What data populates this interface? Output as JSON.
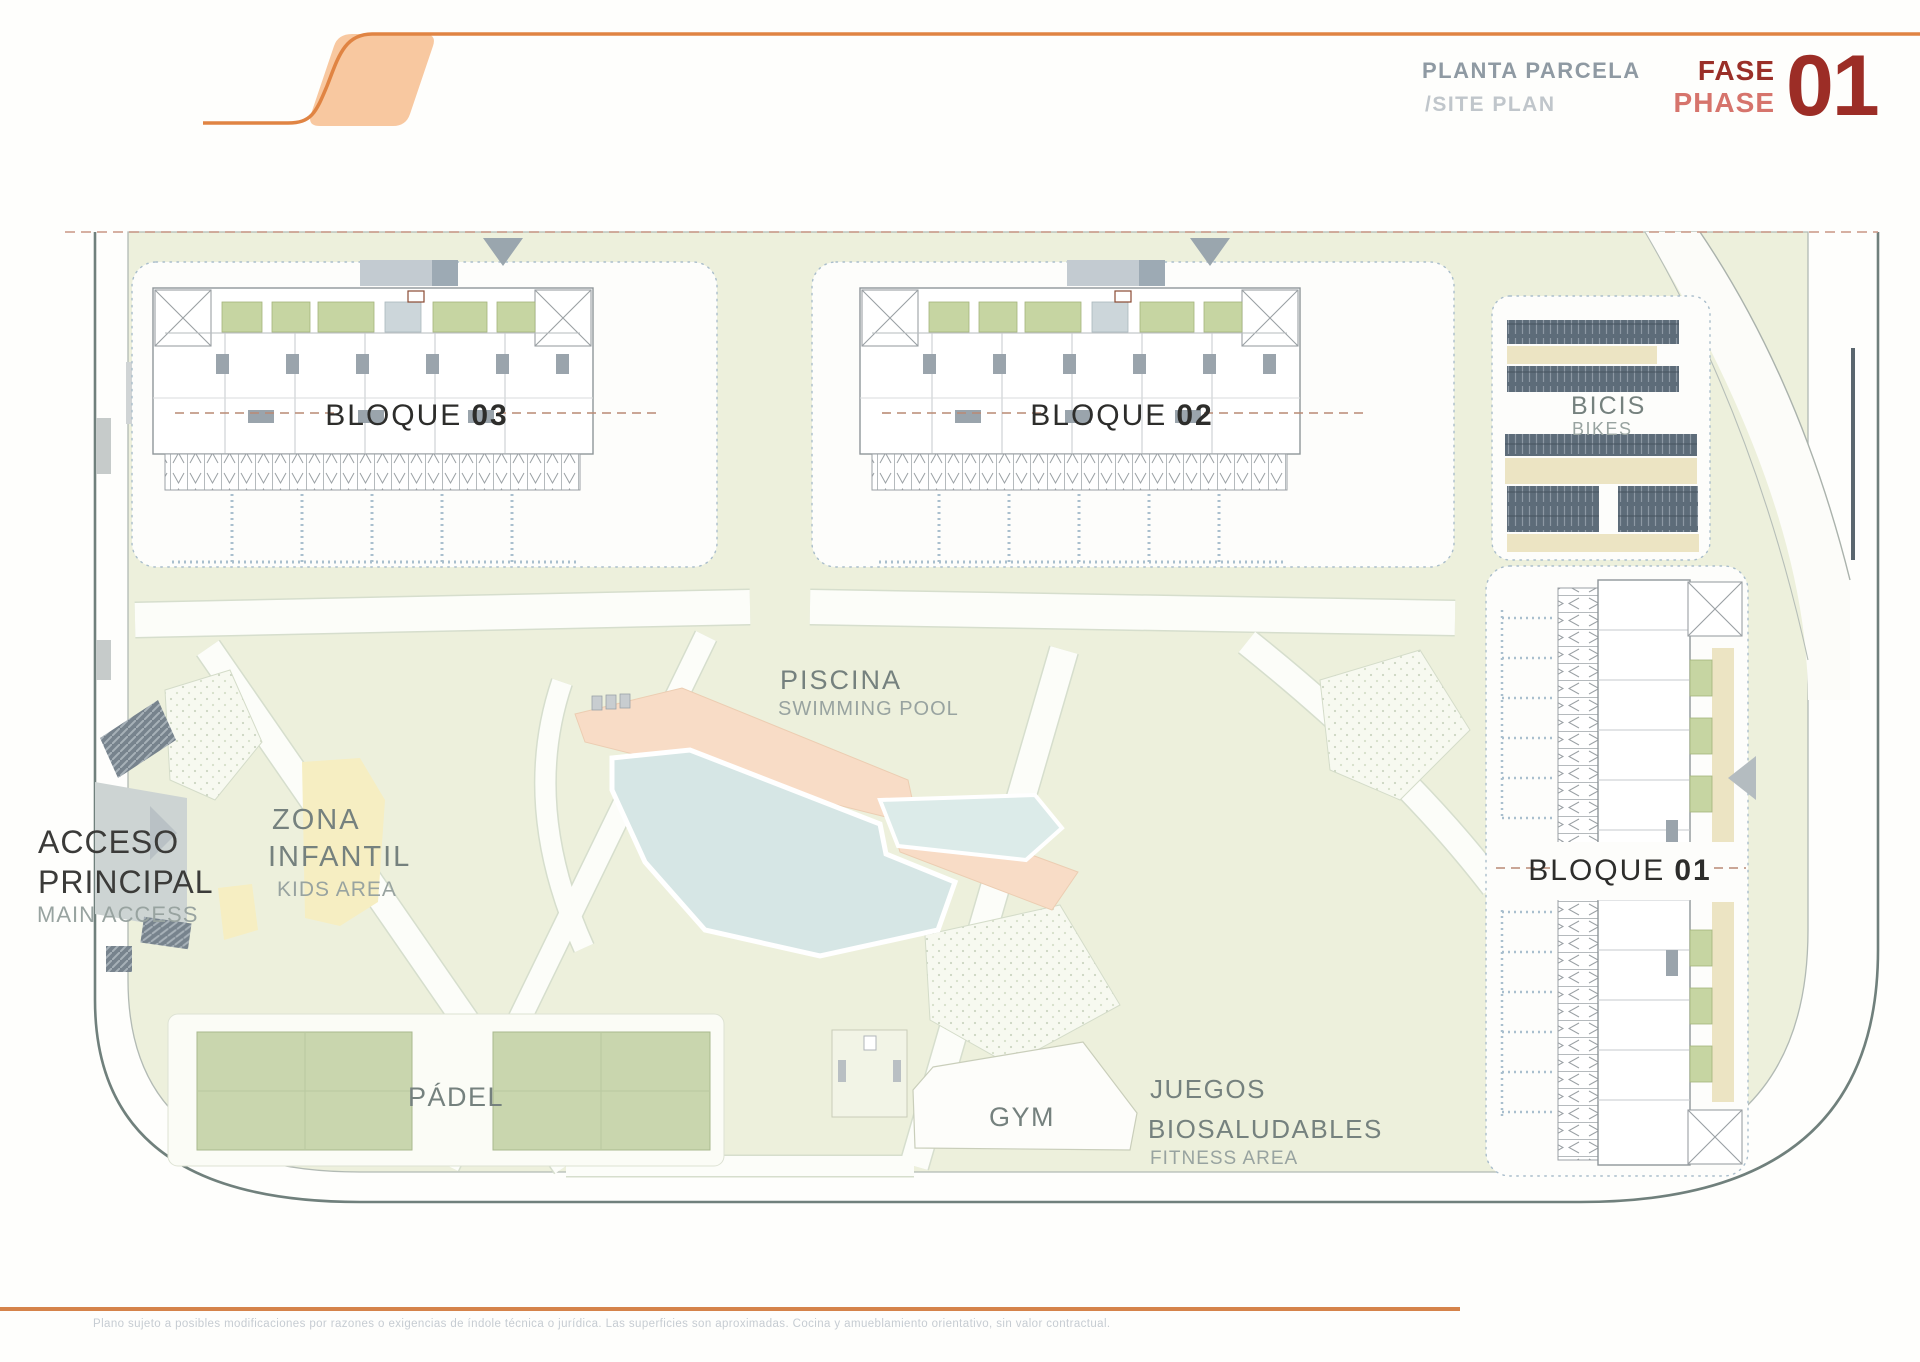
{
  "header": {
    "title_es": "PLANTA PARCELA",
    "title_en": "/SITE PLAN",
    "phase_label_es": "FASE",
    "phase_label_en": "PHASE",
    "phase_number": "01"
  },
  "plan": {
    "blocks": [
      {
        "label": "BLOQUE",
        "number": "03"
      },
      {
        "label": "BLOQUE",
        "number": "02"
      },
      {
        "label": "BLOQUE",
        "number": "01"
      }
    ],
    "amenities": {
      "bikes": {
        "es": "BICIS",
        "en": "BIKES"
      },
      "pool": {
        "es": "PISCINA",
        "en": "SWIMMING POOL"
      },
      "kids": {
        "es_line1": "ZONA",
        "es_line2": "INFANTIL",
        "en": "KIDS AREA"
      },
      "access": {
        "es_line1": "ACCESO",
        "es_line2": "PRINCIPAL",
        "en": "MAIN ACCESS"
      },
      "padel": {
        "es": "PÁDEL"
      },
      "gym": {
        "es": "GYM"
      },
      "fitness": {
        "es_line1": "JUEGOS",
        "es_line2": "BIOSALUDABLES",
        "en": "FITNESS AREA"
      }
    }
  },
  "footer": {
    "disclaimer": "Plano sujeto a posibles modificaciones por razones o exigencias de índole técnica o jurídica. Las superficies son aproximadas. Cocina y amueblamiento orientativo, sin valor contractual."
  },
  "colors": {
    "accent_orange": "#e08443",
    "logo_peach": "#f8c8a0",
    "title_gray": "#8f9aa3",
    "title_light_gray": "#c0c6cb",
    "phase_dark_red": "#9c2d26",
    "phase_light_red": "#d6746c",
    "lawn_green": "#edf0dc",
    "court_green": "#c9d6ae",
    "patio_green": "#c6d5a2",
    "pool_blue": "#d6e6e5",
    "deck_peach": "#f8dcc6",
    "bike_slate": "#5d6c79",
    "kids_yellow": "#f6eec2",
    "boundary_dash_red": "#c89684",
    "footer_text_gray": "#c6ccd2"
  }
}
